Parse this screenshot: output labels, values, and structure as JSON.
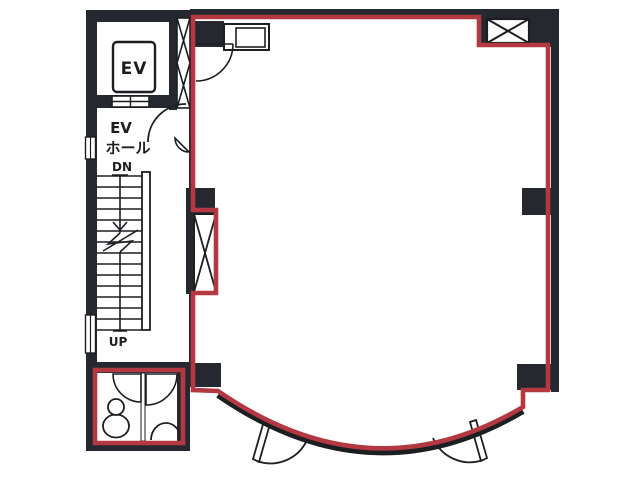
{
  "plan": {
    "type": "building-floor-plan",
    "labels": {
      "ev_car": "EV",
      "ev_hall_line1": "EV",
      "ev_hall_line2": "ホール",
      "stairs_down": "DN",
      "stairs_up": "UP"
    },
    "rooms": [
      "elevator-shaft",
      "elevator-hall",
      "staircase",
      "toilet-block",
      "main-tenant-room"
    ],
    "symbols": [
      "pipe-shaft-x-box-top-right",
      "pipe-shaft-x-box-left-wall",
      "duct-x-strip-beside-elevator",
      "kitchen-counter-with-sink",
      "door-swings",
      "curved-bay-wall-with-two-doors",
      "toilet-fixture",
      "stair-direction-arrow"
    ]
  },
  "colors": {
    "wall": "#262830",
    "line": "#1d1e22",
    "red": "#b43842",
    "bg": "#ffffff"
  }
}
